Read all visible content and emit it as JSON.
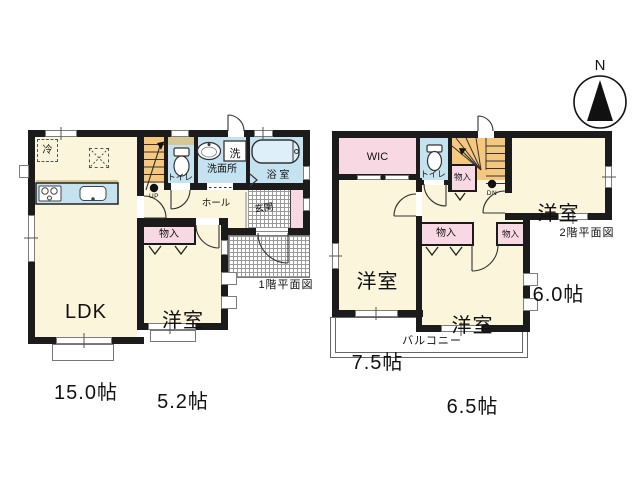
{
  "compass": {
    "north": "N"
  },
  "floor1": {
    "caption": "1階平面図",
    "ldk": {
      "name": "LDK",
      "area": "15.0帖"
    },
    "bedroom": {
      "name": "洋室",
      "area": "5.2帖"
    },
    "fridge": "冷",
    "washer": "洗",
    "toilet": "トイレ",
    "washroom": "洗面所",
    "bath": "浴 室",
    "hall": "ホール",
    "entrance": "玄関",
    "closet": "物入",
    "stairs": "UP"
  },
  "floor2": {
    "caption": "2階平面図",
    "wic": "WIC",
    "toilet": "トイレ",
    "stairs": "DN",
    "closet_stair": "物入",
    "closet_a": "物入",
    "closet_b": "物入",
    "bedroom_a": {
      "name": "洋室",
      "area": "6.0帖"
    },
    "bedroom_b": {
      "name": "洋室",
      "area": "7.5帖"
    },
    "bedroom_c": {
      "name": "洋室",
      "area": "6.5帖"
    },
    "balcony": "バルコニー"
  },
  "colors": {
    "room_cream": "#FBF5DC",
    "wet_blue": "#C5E2F1",
    "closet_pink": "#F8D8E2",
    "stair_orange": "#F6C77F",
    "counter_top_tan": "#D6C795",
    "wall": "#1B1B1B",
    "tile_line": "#9A9A9A"
  }
}
